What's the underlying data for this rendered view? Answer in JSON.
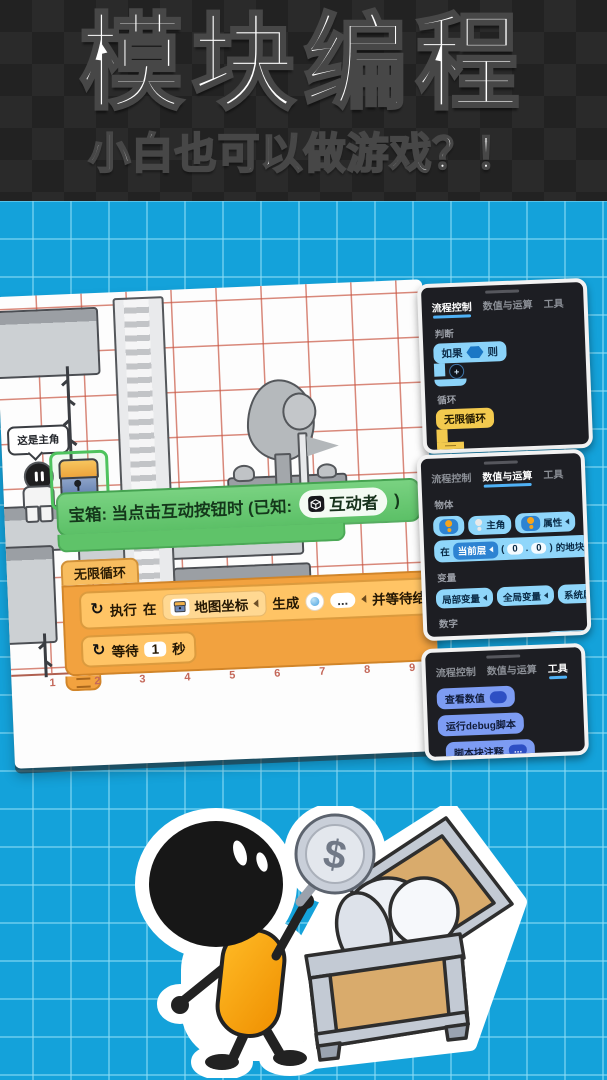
{
  "header": {
    "title": "模块编程",
    "subtitle": "小白也可以做游戏？！"
  },
  "icons": {
    "refresh": "↻",
    "plus": "+",
    "dollar": "$"
  },
  "game_card": {
    "speech_bubble": "这是主角",
    "event_block": {
      "label": "宝箱: 当点击互动按钮时 (已知:",
      "pill": "互动者",
      "suffix": ")"
    },
    "loop_wrapper_label": "无限循环",
    "exec_row": {
      "run": "执行",
      "at": "在",
      "coord": "地图坐标",
      "spawn": "生成",
      "dots": "...",
      "tail": "并等待结束"
    },
    "wait_row": {
      "wait": "等待",
      "value": "1",
      "unit": "秒"
    },
    "axis_labels": [
      "1",
      "2",
      "3",
      "4",
      "5",
      "6",
      "7",
      "8",
      "9"
    ]
  },
  "panel_flow": {
    "tabs": [
      "流程控制",
      "数值与运算",
      "工具"
    ],
    "section_judge": "判断",
    "if_block": {
      "if": "如果",
      "then": "则"
    },
    "section_loop": "循环",
    "infinite_loop": "无限循环",
    "loop_block": {
      "loop": "循环",
      "count": "10",
      "times": "次"
    }
  },
  "panel_math": {
    "tabs": [
      "流程控制",
      "数值与运算",
      "工具"
    ],
    "section_object": "物体",
    "object_row": {
      "protagonist": "主角",
      "attribute": "属性"
    },
    "tile_row": {
      "at": "在",
      "layer": "当前层",
      "open": "(",
      "x": "0",
      "dot": ".",
      "y": "0",
      "close": ")",
      "suffix": "的地块"
    },
    "section_variable": "变量",
    "variable_blocks": [
      "局部变量",
      "全局变量",
      "系统属性"
    ],
    "section_number": "数字",
    "number_row1": {
      "n": "123",
      "a": "2",
      "op": "+",
      "b": "3",
      "c": "7",
      "slash": "/",
      "d": "3",
      "suffix": "的余数"
    },
    "number_row2": {
      "fn": "sin",
      "angle": "90",
      "dec": "2.5",
      "attr": "属性"
    }
  },
  "panel_tools": {
    "tabs": [
      "流程控制",
      "数值与运算",
      "工具"
    ],
    "blocks": {
      "view_value": "查看数值",
      "run_debug": "运行debug脚本",
      "comment": "脚本块注释",
      "dots": "..."
    }
  }
}
